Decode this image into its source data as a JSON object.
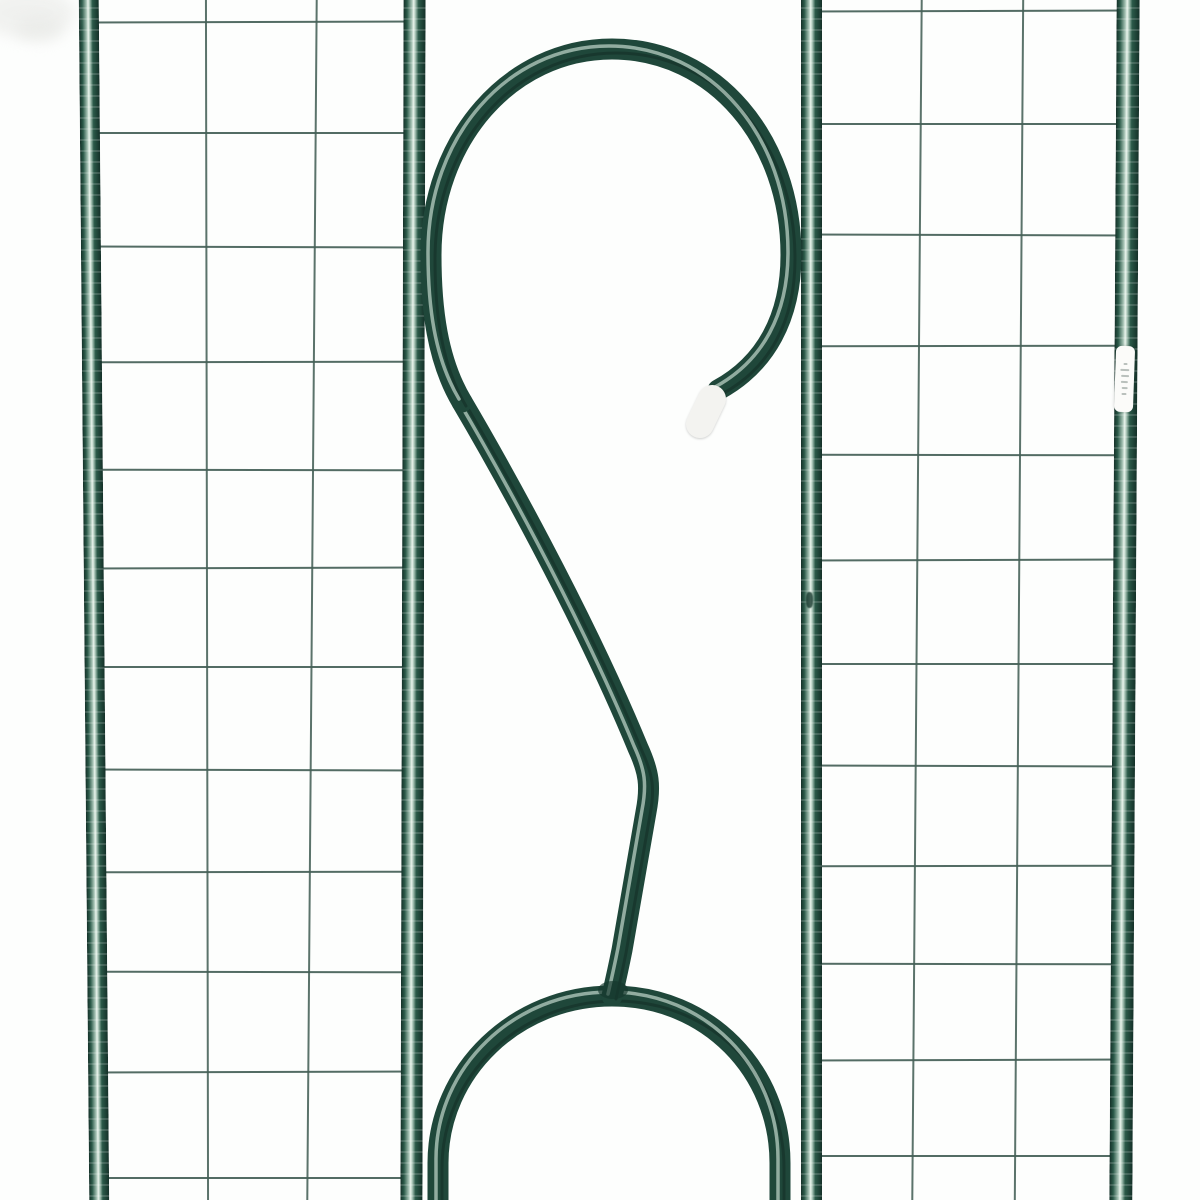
{
  "scene": {
    "alt_text": "Close-up of a dark green metal garden trellis: two wire-grid side panels on tubular frame posts with a decorative scroll hook and arch in the center; white plastic cap on the hook tip; small white hang tag on the right post",
    "background": "#fdfefd",
    "colors": {
      "background": "#fdfefd",
      "frame_edge": "#143028",
      "frame_mid": "#2b5a49",
      "frame_light": "#a8c4b6",
      "frame_glint": "#e9f4ec",
      "tube": "#1f473a",
      "tube_highlight": "#def0e5",
      "wire": "#44605-7",
      "cap": "#f3f3f0",
      "tag_bg": "#fbfbf9",
      "tag_mark": "#a9b2ac",
      "weld": "#16382d",
      "smudge": "#e7e8e5"
    }
  },
  "posts": [
    {
      "id": "left-outer-post",
      "x": 84,
      "w": 20,
      "tilt": -0.5
    },
    {
      "id": "left-inner-post",
      "x": 402,
      "w": 22,
      "tilt": 0.15
    },
    {
      "id": "right-inner-post",
      "x": 801,
      "w": 21,
      "tilt": 0.0
    },
    {
      "id": "right-outer-post",
      "x": 1113,
      "w": 23,
      "tilt": 0.35
    }
  ],
  "mesh": {
    "left": {
      "x1": 90,
      "x2": 422,
      "rows": [
        22,
        133,
        247,
        362,
        470,
        568,
        667,
        770,
        872,
        972,
        1072,
        1178
      ],
      "cols": [
        {
          "x": 206,
          "tilt": -0.1
        },
        {
          "x": 311,
          "tilt": 0.45
        }
      ]
    },
    "right": {
      "x1": 806,
      "x2": 1132,
      "rows": [
        11,
        124,
        235,
        346,
        455,
        560,
        664,
        766,
        866,
        964,
        1060,
        1156
      ],
      "cols": [
        {
          "x": 916,
          "tilt": 0.45
        },
        {
          "x": 1018,
          "tilt": 0.4
        }
      ]
    }
  },
  "hook": {
    "stroke_width": 21,
    "loop_path": "M 462 402 C 437 360 431 308 431 255 C 431 140 510 49 612 49 C 715 49 791 140 791 255 C 791 317 766 364 718 390",
    "s_path": "M 462 402 C 495 458 582 612 638 748 C 649 772 651 786 646 812 L 622 950 C 618 970 615 983 612 996",
    "arch_path": "M 438 1206 L 438 1163 C 438 1071 516 996 612 996 C 708 996 780 1071 780 1163 L 780 1206",
    "cap": {
      "x1": 712,
      "y1": 399,
      "x2": 700,
      "y2": 424,
      "w": 28
    },
    "weld": {
      "cx": 613,
      "cy": 990,
      "rx": 15,
      "ry": 9
    }
  },
  "tag": {
    "x": 1115,
    "y": 346,
    "w": 19,
    "h": 66,
    "tilt": 2,
    "marks": 6
  },
  "chip": {
    "x": 806,
    "y": 592,
    "w": 7,
    "h": 16
  },
  "smudges": [
    {
      "x": -20,
      "y": -12,
      "w": 95,
      "h": 50
    },
    {
      "x": 16,
      "y": 16,
      "w": 48,
      "h": 26
    }
  ]
}
